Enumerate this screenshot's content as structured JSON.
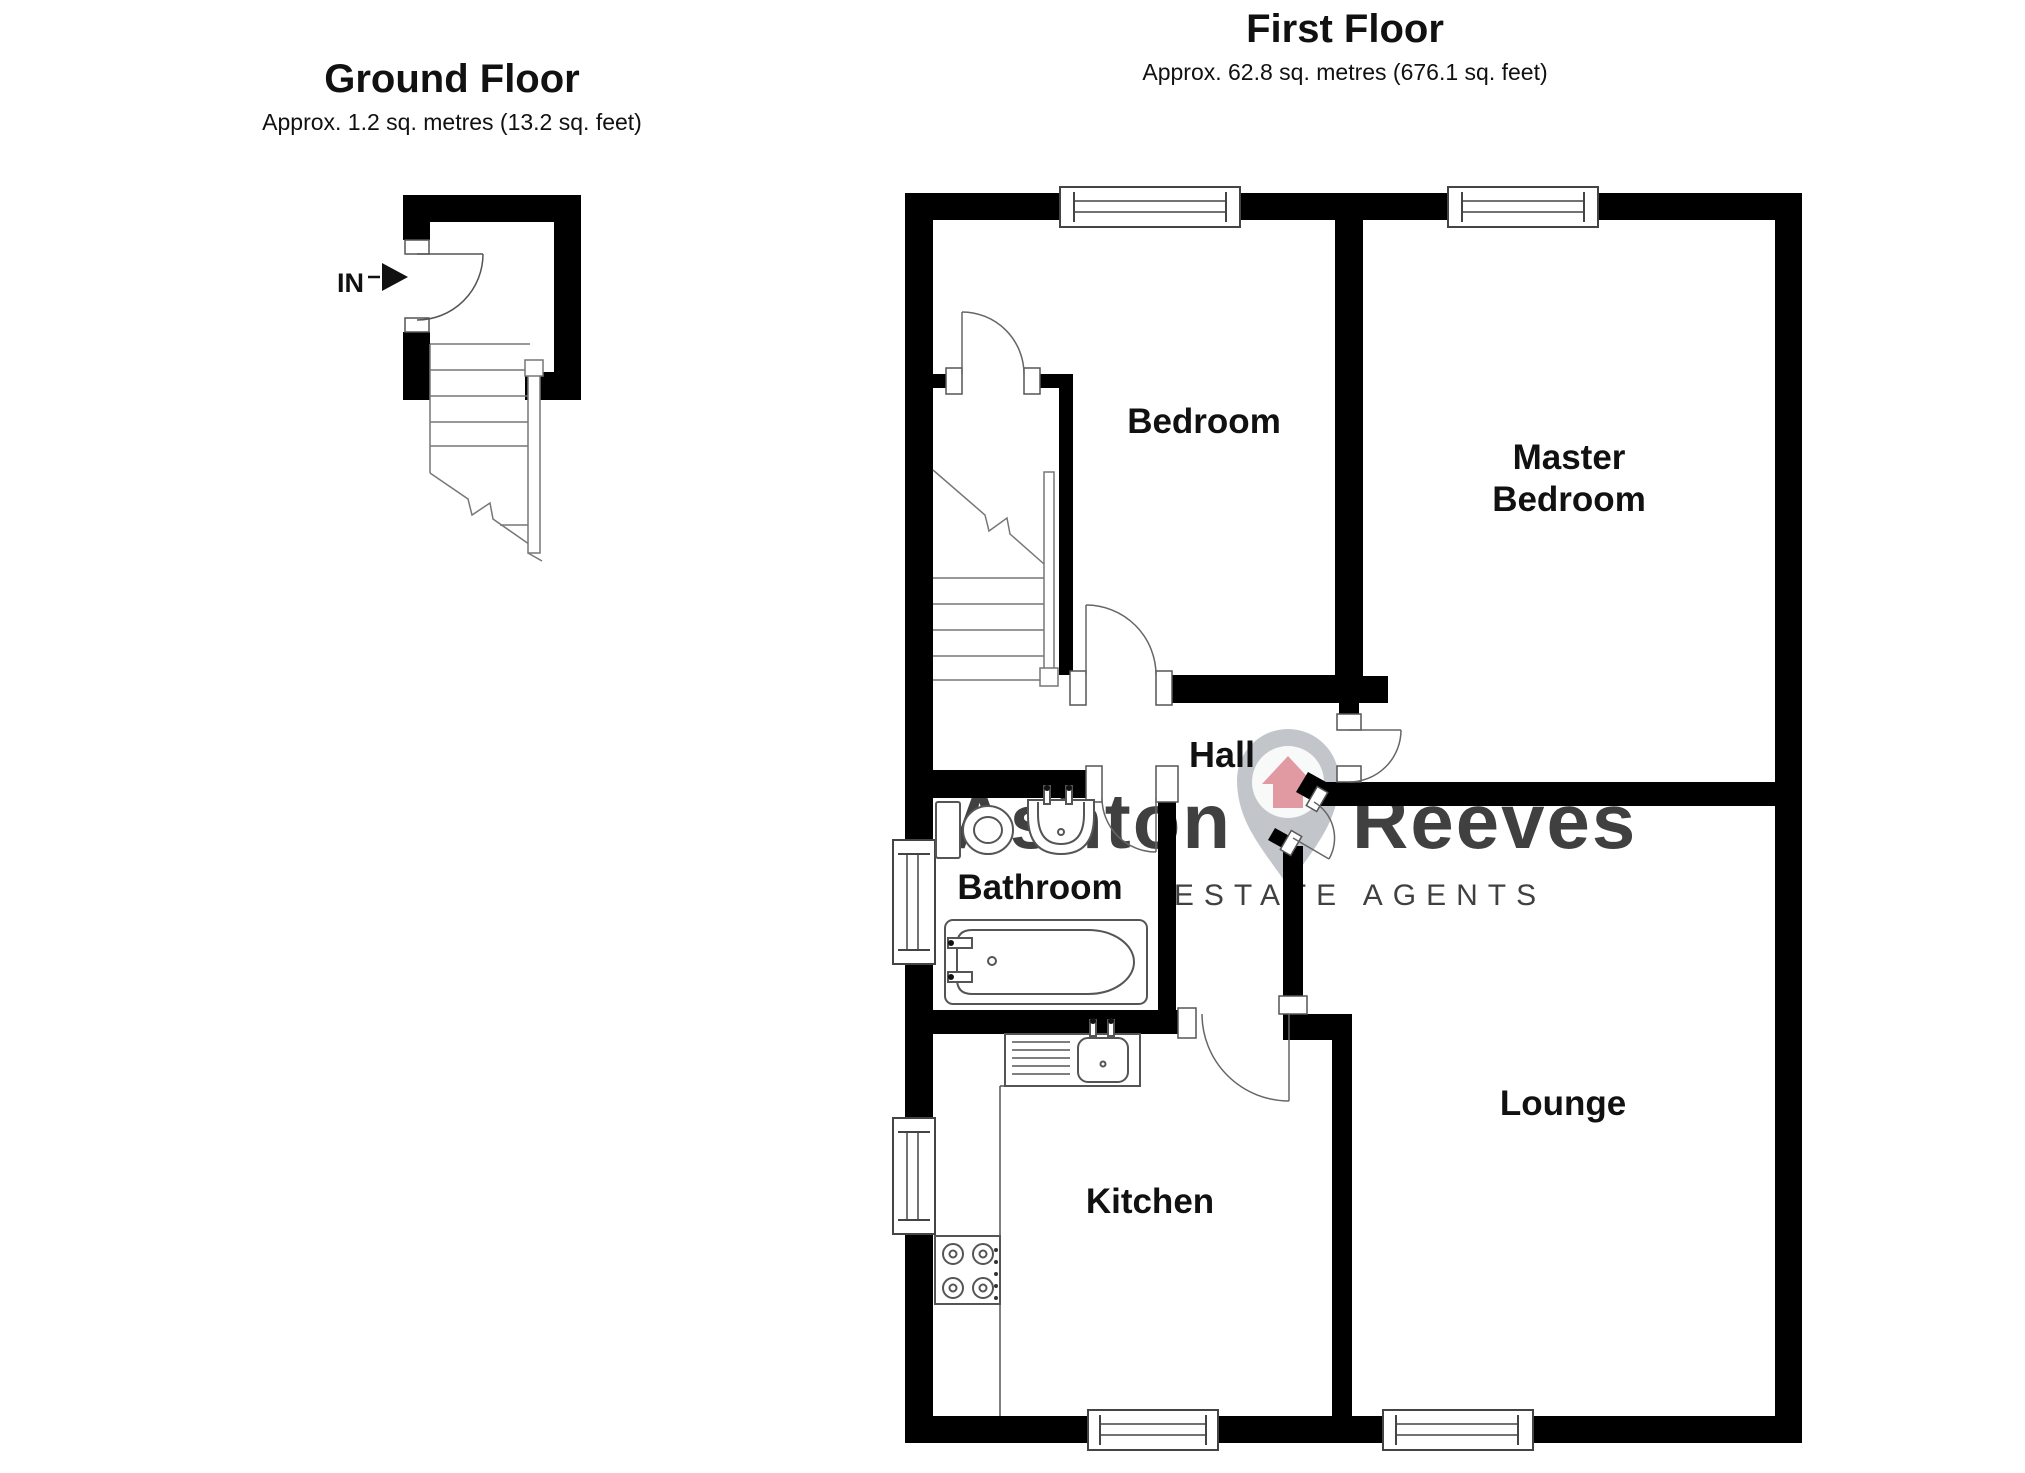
{
  "ground_floor": {
    "title": "Ground Floor",
    "subtitle": "Approx. 1.2 sq. metres (13.2 sq. feet)",
    "entrance_label": "IN"
  },
  "first_floor": {
    "title": "First Floor",
    "subtitle": "Approx. 62.8 sq. metres (676.1 sq. feet)",
    "rooms": {
      "bedroom": "Bedroom",
      "master_line1": "Master",
      "master_line2": "Bedroom",
      "hall": "Hall",
      "bathroom": "Bathroom",
      "kitchen": "Kitchen",
      "lounge": "Lounge"
    }
  },
  "watermark": {
    "brand_first": "Ashton",
    "brand_second": "Reeves",
    "tagline": "ESTATE AGENTS",
    "colors": {
      "first": "#cccccc",
      "second": "#f0ccd1",
      "tagline": "#e2e2e2",
      "pin": "#9aa0a8",
      "house": "#d9747f"
    }
  },
  "plan": {
    "wall_color": "#000000",
    "line_color": "#555555"
  }
}
